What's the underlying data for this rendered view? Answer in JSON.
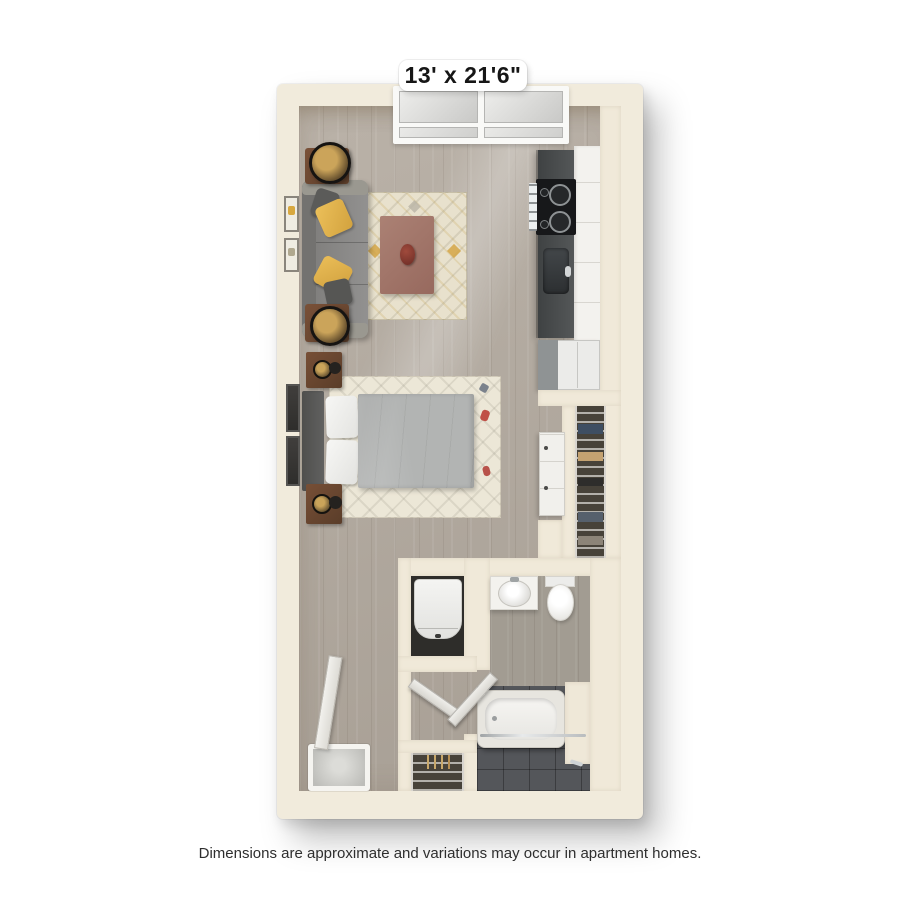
{
  "floorplan": {
    "dimension_label": "13' x 21'6\"",
    "disclaimer": "Dimensions are approximate and variations may occur in apartment homes.",
    "colors": {
      "wall": "#f0e9d9",
      "wood_floor": "#b2a99e",
      "bathroom_tile": "#54565a",
      "kitchen_counter": "#474a4b",
      "sofa": "#8d8c8a",
      "accent_pillow": "#e2b34a",
      "wood_furniture": "#6e4a33",
      "duvet": "#b2b4b3",
      "fixtures": "#f6f5f2"
    },
    "items": [
      "window",
      "sofa",
      "accent-pillows",
      "end-tables",
      "table-lamps",
      "coffee-table",
      "living-rug",
      "wall-art",
      "kitchen-counter",
      "stove",
      "kitchen-sink",
      "kitchen-cabinets",
      "refrigerator",
      "bed",
      "headboard",
      "nightstands",
      "bed-rug",
      "dresser",
      "wire-closet",
      "washer-dryer",
      "linen-closet",
      "bathroom-sink",
      "toilet",
      "bathtub",
      "shower-rod",
      "towel-bar",
      "interior-doors",
      "entry-door",
      "doormat"
    ]
  }
}
